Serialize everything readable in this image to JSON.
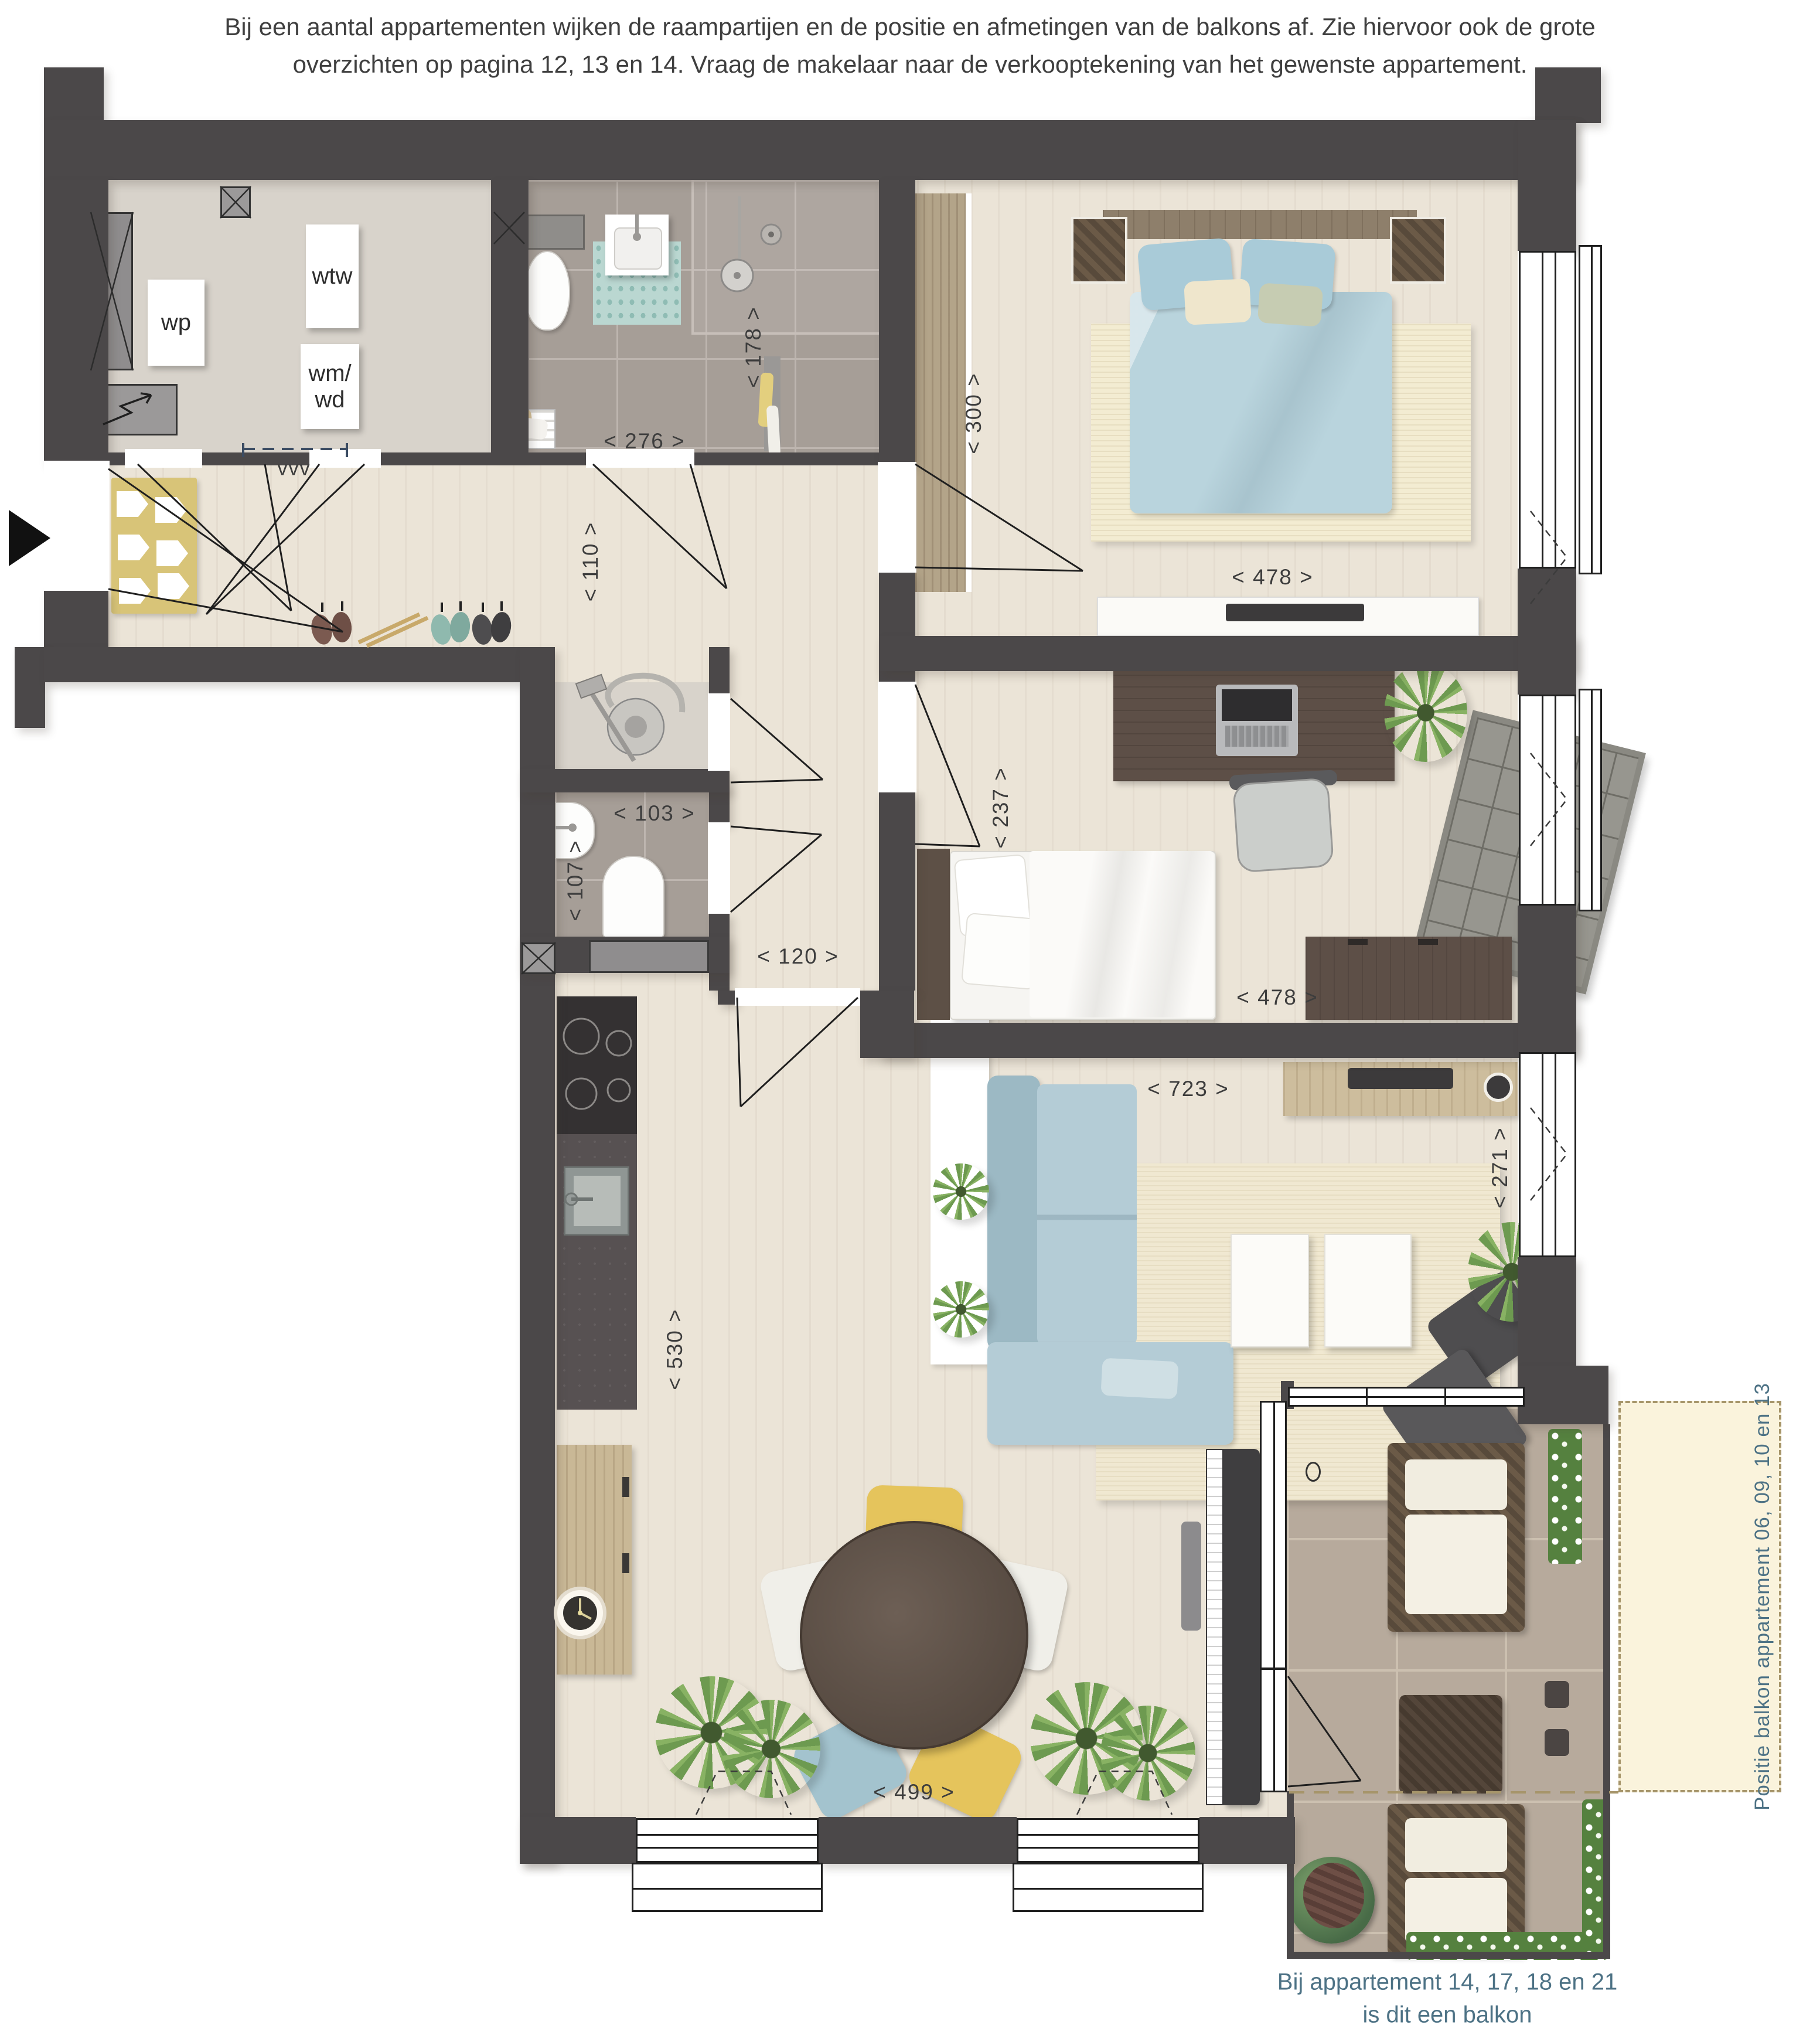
{
  "header": {
    "line1": "Bij een aantal appartementen wijken de raampartijen en de positie en afmetingen van de balkons af. Zie hiervoor ook de grote",
    "line2": "overzichten op pagina 12, 13 en 14. Vraag de makelaar naar de verkooptekening van het gewenste appartement."
  },
  "units": {
    "wp": "wp",
    "wtw": "wtw",
    "wm": "wm/",
    "wd": "wd",
    "vvv": "vvv"
  },
  "dimensions": {
    "bathroom_width": "< 276 >",
    "bathroom_depth": "< 178 >",
    "bedroom1_depth": "< 300 >",
    "bedroom1_width": "< 478 >",
    "hall_width": "< 110 >",
    "wc_width": "< 103 >",
    "wc_depth": "< 107 >",
    "hall_passage": "< 120 >",
    "bedroom2_depth": "< 237 >",
    "bedroom2_width": "< 478 >",
    "living_width": "< 723 >",
    "living_depth": "< 271 >",
    "kitchen_depth": "< 530 >",
    "dining_width": "< 499 >"
  },
  "annotations": {
    "balcony_side_note": "Positie balkon appartement 06, 09, 10 en 13",
    "balcony_caption_line1": "Bij appartement 14, 17, 18 en 21",
    "balcony_caption_line2": "is dit een balkon"
  },
  "colors": {
    "wall": "#4b4849",
    "note_blue": "#4d7285",
    "balcony_highlight": "#faf3dc",
    "floor_wood": "#ebe4d7",
    "tile_grey": "#a69e97",
    "terrace_tile": "#b7aa9c"
  }
}
